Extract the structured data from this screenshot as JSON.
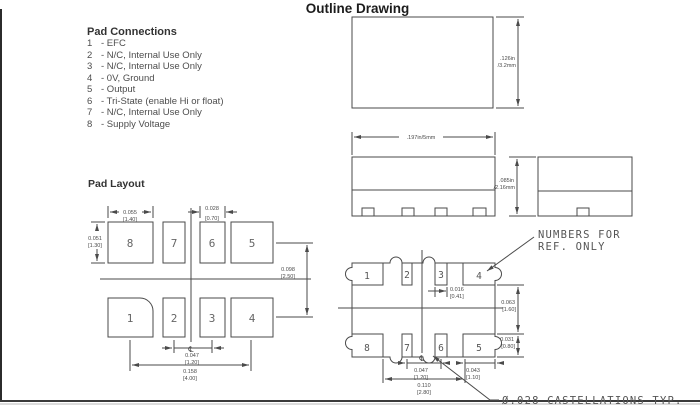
{
  "page": {
    "title": "Outline Drawing"
  },
  "colors": {
    "ink": "#4a4a4a"
  },
  "pad_connections": {
    "heading": "Pad Connections",
    "items": [
      {
        "num": "1",
        "desc": "- EFC"
      },
      {
        "num": "2",
        "desc": "- N/C, Internal Use Only"
      },
      {
        "num": "3",
        "desc": "- N/C, Internal Use Only"
      },
      {
        "num": "4",
        "desc": "- 0V, Ground"
      },
      {
        "num": "5",
        "desc": "- Output"
      },
      {
        "num": "6",
        "desc": "- Tri-State (enable Hi or float)"
      },
      {
        "num": "7",
        "desc": "- N/C, Internal Use Only"
      },
      {
        "num": "8",
        "desc": "- Supply Voltage"
      }
    ]
  },
  "pad_layout": {
    "heading": "Pad Layout",
    "top_row": [
      "8",
      "7",
      "6",
      "5"
    ],
    "bottom_row": [
      "1",
      "2",
      "3",
      "4"
    ],
    "centerline_symbol": "℄",
    "dims": {
      "big_pad_width": {
        "in": "0.055",
        "mm": "[1.40]"
      },
      "small_pad_width": {
        "in": "0.028",
        "mm": "[0.70]"
      },
      "pad_height": {
        "in": "0.051",
        "mm": "[1.30]"
      },
      "row_pitch": {
        "in": "0.098",
        "mm": "[2.50]"
      },
      "pad_pitch": {
        "in": "0.047",
        "mm": "[1.20]"
      },
      "overall_span": {
        "in": "0.158",
        "mm": "[4.00]"
      }
    }
  },
  "outline_views": {
    "top_view": {
      "height_dim_line1": ".126in",
      "height_dim_line2": "/3.2mm"
    },
    "front_view": {
      "width_dim": ".197in/5mm"
    },
    "side_view": {
      "height_dim_line1": ".085in",
      "height_dim_line2": "/2.16mm"
    },
    "bottom_view": {
      "top_row": [
        "1",
        "2",
        "3",
        "4"
      ],
      "bottom_row": [
        "8",
        "7",
        "6",
        "5"
      ],
      "centerline_symbol": "℄",
      "note_ref_line1": "NUMBERS FOR",
      "note_ref_line2": "REF. ONLY",
      "note_castellations": "Ø.028 CASTELLATIONS TYP.",
      "dims": {
        "pad_width": {
          "in": "0.016",
          "mm": "[0.41]"
        },
        "center_to_edge": {
          "in": "0.063",
          "mm": "[1.60]"
        },
        "pad_depth": {
          "in": "0.031",
          "mm": "[0.80]"
        },
        "pad_pitch": {
          "in": "0.047",
          "mm": "[1.20]"
        },
        "center_span": {
          "in": "0.110",
          "mm": "[2.80]"
        },
        "corner_pad": {
          "in": "0.043",
          "mm": "[1.10]"
        }
      }
    }
  }
}
